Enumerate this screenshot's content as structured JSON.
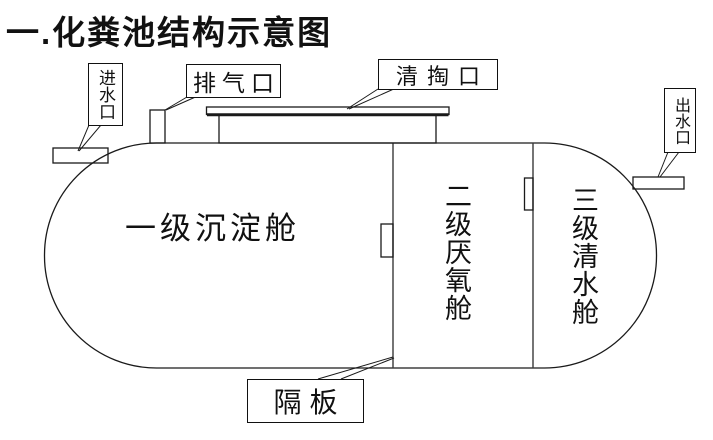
{
  "title": "一.化粪池结构示意图",
  "diagram": {
    "type": "septic-tank-structure-schematic",
    "labels": {
      "inlet": "进水口",
      "vent": "排气口",
      "cleanout": "清掏口",
      "outlet": "出水口",
      "baffle": "隔板"
    },
    "chambers": [
      {
        "name": "一级沉淀舱",
        "orientation": "horizontal"
      },
      {
        "name": "二级厌氧舱",
        "orientation": "vertical"
      },
      {
        "name": "三级清水舱",
        "orientation": "vertical"
      }
    ],
    "colors": {
      "line": "#1a1a1a",
      "background": "#ffffff",
      "text": "#111111"
    }
  }
}
